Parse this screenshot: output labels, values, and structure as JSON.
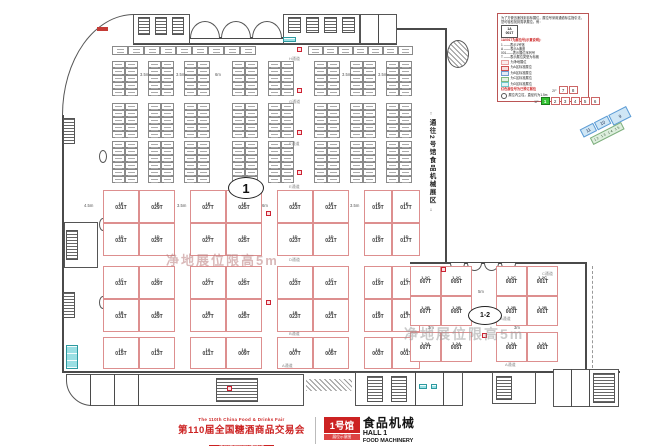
{
  "footer": {
    "fair_name_en": "The 110th China Food & Drinks Fair",
    "fair_name_cn": "第110届全国糖酒商品交易会",
    "venue": "中国西部国际博览城",
    "hall_badge": "1号馆",
    "hall_badge_sub": "展位示意图",
    "hall_title_cn": "食品机械",
    "hall_title_en1": "HALL 1",
    "hall_title_en2": "FOOD MACHINERY",
    "accent_red": "#cc1f1f"
  },
  "corridor": {
    "text": "通往2号馆食品机械展区",
    "arrow_up": "↑",
    "arrow_down": "↓"
  },
  "ovals": {
    "hall1": "1",
    "hall12": "1-2"
  },
  "watermark": {
    "text": "净地展位限高5m"
  },
  "legend": {
    "intro": "为了方便迅速找到目标展位，展位号采用通道标注指引法，您可轻松找到需求展位。例：",
    "sample_top": "1A",
    "sample_bot": "001T",
    "headline": "1A001T为展位号(示意说明)：",
    "lines": [
      "1 ——表示1号馆",
      "A ——表示A通道",
      "001——表示展位序列号",
      "T ——表示展位类型为标摊"
    ],
    "chips": [
      {
        "color": "#e8a0a0",
        "text": "为净地展位"
      },
      {
        "color": "#d05050",
        "text": "为A区标准展位"
      },
      {
        "color": "#6f9bd0",
        "text": "为B区标准展位"
      },
      {
        "color": "#7fb87f",
        "text": "为C区标准展位"
      },
      {
        "color": "#6fc8cc",
        "text": "为D区标准展位"
      }
    ],
    "note_red": "红色展位号为已预订展位",
    "note_pillar": "展位内立柱，直径约为1.5m"
  },
  "hall_nav": {
    "floor2_label": "2F",
    "floor2": [
      "7",
      "8"
    ],
    "floor1_label": "1F",
    "floor1": [
      "1",
      "2",
      "3",
      "4",
      "5",
      "6"
    ],
    "active": "1",
    "wing_blue": [
      "11",
      "10",
      "9"
    ],
    "wing_green": "12 13 14 15"
  },
  "aisles": {
    "w35": "3.5m",
    "w45": "4.5m",
    "w6": "6m",
    "w5": "5m",
    "w3": "3m"
  },
  "channels": {
    "A": "A通道",
    "B": "B通道",
    "C": "C通道",
    "D": "D通道",
    "E": "E通道",
    "F": "F通道",
    "G": "G通道",
    "H": "H通道"
  },
  "booths_left": {
    "rows": [
      {
        "series": "1E",
        "labels": [
          "1E 031T",
          "1E 029T",
          "1E 027T",
          "1E 025T",
          "1E 023T",
          "1E 021T",
          "1E 019T",
          "1E 017T"
        ]
      },
      {
        "series": "1D",
        "labels": [
          "1D 031T",
          "1D 029T",
          "1D 027T",
          "1D 025T",
          "1D 023T",
          "1D 021T",
          "1D 019T",
          "1D 017T"
        ]
      },
      {
        "series": "1C",
        "labels": [
          "1C 031T",
          "1C 029T",
          "1C 027T",
          "1C 025T",
          "1C 023T",
          "1C 021T",
          "1C 019T",
          "1C 017T"
        ]
      },
      {
        "series": "1B",
        "labels": [
          "1B 031T",
          "1B 029T",
          "1B 027T",
          "1B 025T",
          "1B 023T",
          "1B 021T",
          "1B 019T",
          "1B 017T"
        ]
      },
      {
        "series": "1A",
        "labels": [
          "1A 015T",
          "1A 013T",
          "1A 011T",
          "1A 009T",
          "1A 007T",
          "1A 005T",
          "1A 003T",
          "1A 001T"
        ]
      }
    ]
  },
  "booths_annex": {
    "rows": [
      {
        "series": "1-2C",
        "labels": [
          "1-2C 007T",
          "1-2C 005T",
          "1-2C 003T",
          "1-2C 001T"
        ]
      },
      {
        "series": "1-2B",
        "labels": [
          "1-2B 007T",
          "1-2B 005T",
          "1-2B 003T",
          "1-2B 001T"
        ]
      },
      {
        "series": "1-2A",
        "labels": [
          "1-2A 007T",
          "1-2A 005T",
          "1-2A 003T",
          "1-2A 001T"
        ]
      }
    ]
  }
}
